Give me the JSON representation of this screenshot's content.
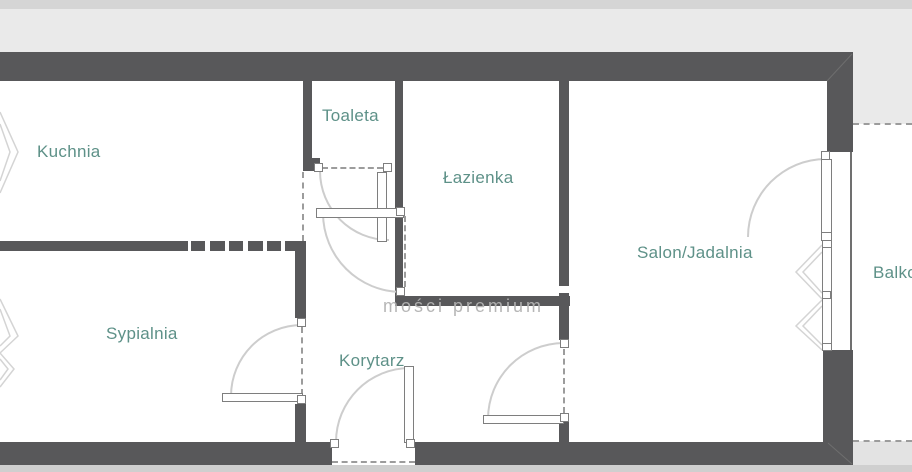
{
  "floorplan": {
    "rooms": {
      "kuchnia": {
        "label": "Kuchnia"
      },
      "toaleta": {
        "label": "Toaleta"
      },
      "lazienka": {
        "label": "Łazienka"
      },
      "salon_jadalnia": {
        "label": "Salon/Jadalnia"
      },
      "sypialnia": {
        "label": "Sypialnia"
      },
      "korytarz": {
        "label": "Korytarz"
      },
      "balkon": {
        "label": "Balkon"
      }
    },
    "watermark": {
      "text": "mości premium"
    },
    "colors": {
      "wall": "#58585a",
      "room_label": "#5e9188",
      "outside_gray": "#eaeaea",
      "door_arc": "#cdcdcd"
    }
  }
}
